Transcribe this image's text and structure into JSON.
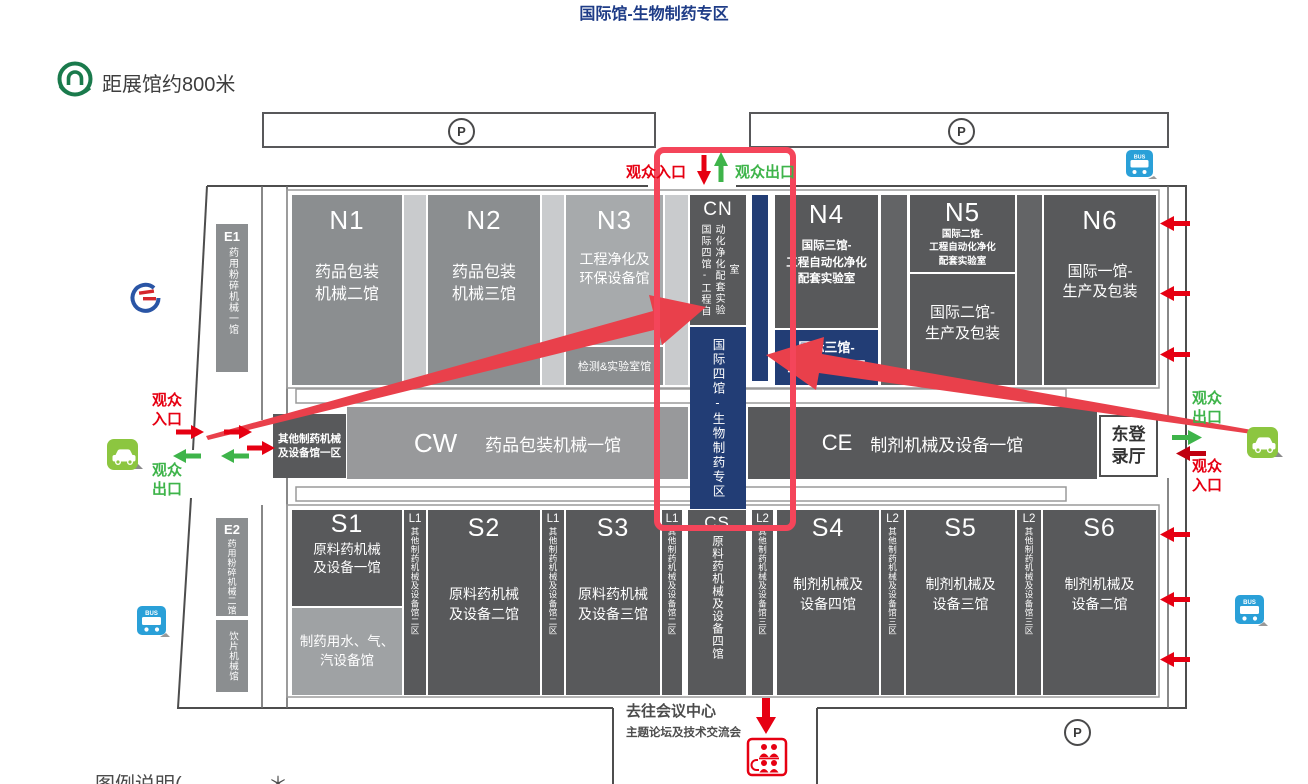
{
  "title": "国际馆-生物制药专区",
  "metro_note": "距展馆约800米",
  "parking_label": "P",
  "bus_label": "BUS",
  "entrance": {
    "visitor_in": "观众入口",
    "visitor_out": "观众出口"
  },
  "halls": {
    "e1": {
      "code": "E1",
      "name": "药用粉碎机械一馆"
    },
    "e2": {
      "code": "E2",
      "name": "药用粉碎机械二馆",
      "name2": "饮片机械馆"
    },
    "n1": {
      "code": "N1",
      "name": "药品包装\n机械二馆"
    },
    "n2": {
      "code": "N2",
      "name": "药品包装\n机械三馆"
    },
    "n3": {
      "code": "N3",
      "name": "工程净化及\n环保设备馆",
      "sub": "检测&实验室馆"
    },
    "cn": {
      "code": "CN",
      "name": "国际四馆-工程自动化净化配套实验室",
      "blue": "国际四馆-生物制药专区"
    },
    "n4": {
      "code": "N4",
      "name": "国际三馆-\n工程自动化净化\n配套实验室",
      "blue": "国际三馆-\n生物制药专区"
    },
    "n5": {
      "code": "N5",
      "name": "国际二馆-\n工程自动化净化\n配套实验室",
      "name2": "国际二馆-\n生产及包装"
    },
    "n6": {
      "code": "N6",
      "name": "国际一馆-\n生产及包装"
    },
    "cw": {
      "code": "CW",
      "name": "药品包装机械一馆"
    },
    "ce": {
      "code": "CE",
      "name": "制剂机械及设备一馆"
    },
    "other1": {
      "name": "其他制药机械\n及设备馆一区"
    },
    "east_hall": {
      "name": "东登\n录厅"
    },
    "s1": {
      "code": "S1",
      "name": "原料药机械\n及设备一馆",
      "sub": "制药用水、气、\n汽设备馆"
    },
    "s2": {
      "code": "S2",
      "name": "原料药机械\n及设备二馆"
    },
    "s3": {
      "code": "S3",
      "name": "原料药机械\n及设备三馆"
    },
    "cs": {
      "code": "CS",
      "name": "原料药机械及设备四馆"
    },
    "s4": {
      "code": "S4",
      "name": "制剂机械及\n设备四馆"
    },
    "s5": {
      "code": "S5",
      "name": "制剂机械及\n设备三馆"
    },
    "s6": {
      "code": "S6",
      "name": "制剂机械及\n设备二馆"
    },
    "l1": {
      "code": "L1",
      "name": "其他制药机械及设备馆二区"
    },
    "l2": {
      "code": "L2",
      "name": "其他制药机械及设备馆三区"
    }
  },
  "footer": {
    "conference": "去往会议中心",
    "conference_sub": "主题论坛及技术交流会",
    "legend": "图例说明(",
    "legend_fragment": "＊"
  },
  "colors": {
    "accent_red": "#e60012",
    "accent_green": "#3eb44a",
    "hall_navy": "#223d75",
    "highlight_red": "#f4455a",
    "bus_blue": "#2aa0d8",
    "taxi_green": "#8cc640",
    "metro_green": "#1a7a4c",
    "title_navy": "#1e3c87"
  }
}
